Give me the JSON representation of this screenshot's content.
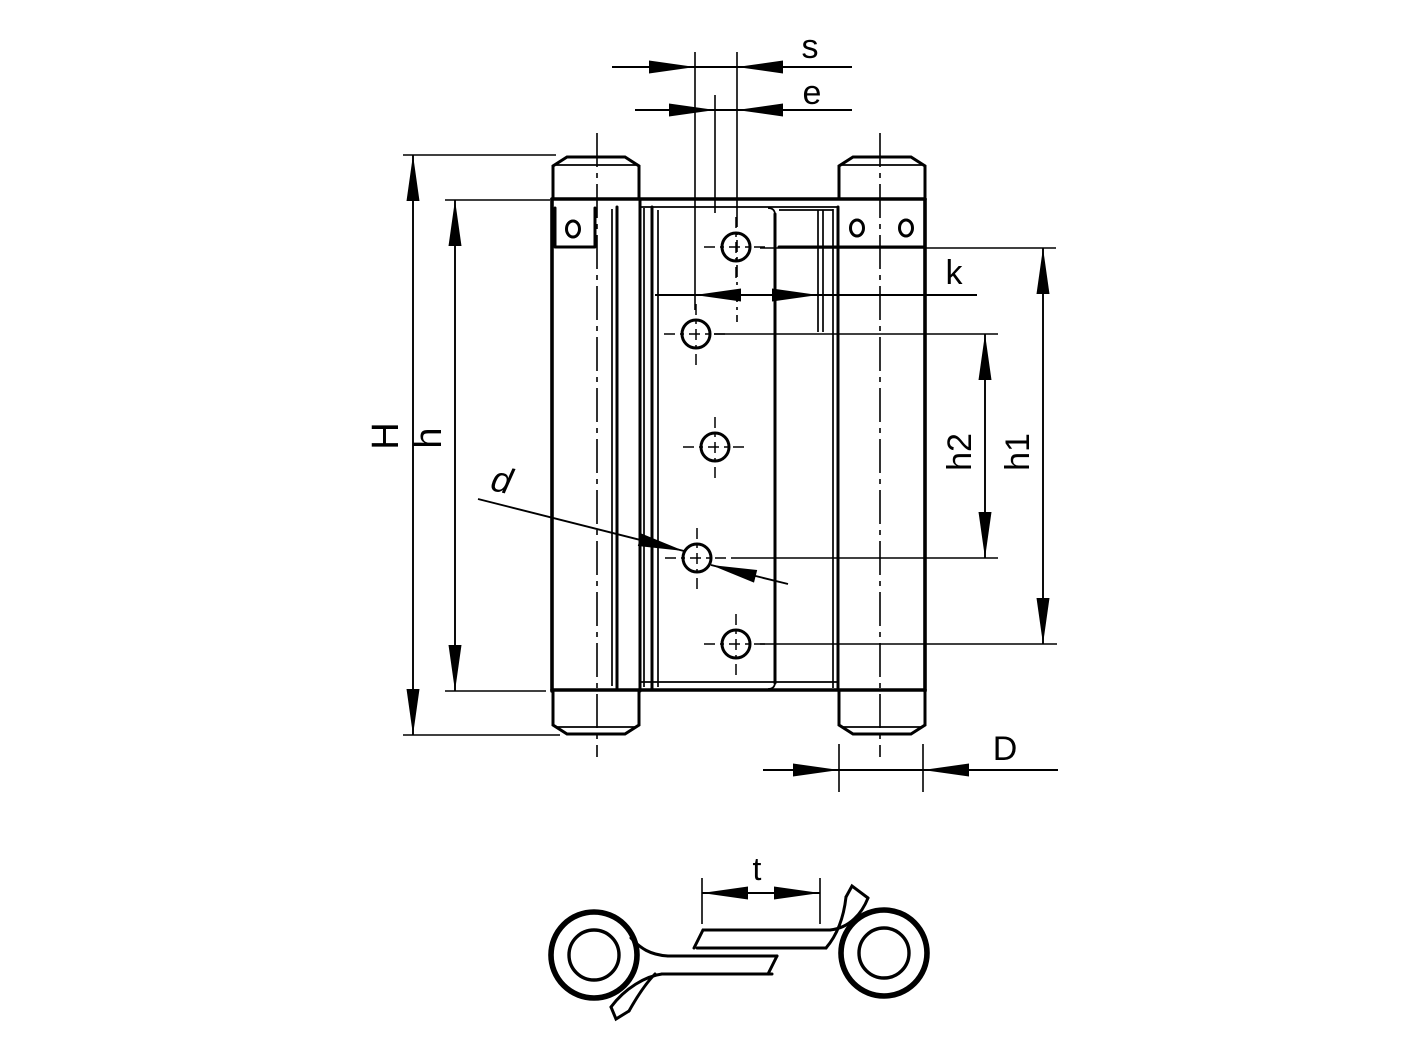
{
  "drawing": {
    "type": "technical-dimension-drawing",
    "subject": "double-action spring hinge, front view and cross-section",
    "line_color": "#000000",
    "background_color": "#ffffff"
  },
  "dimensions": {
    "s": "s",
    "e": "e",
    "k": "k",
    "H": "H",
    "h": "h",
    "h1": "h1",
    "h2": "h2",
    "d": "d",
    "D": "D",
    "t": "t"
  }
}
